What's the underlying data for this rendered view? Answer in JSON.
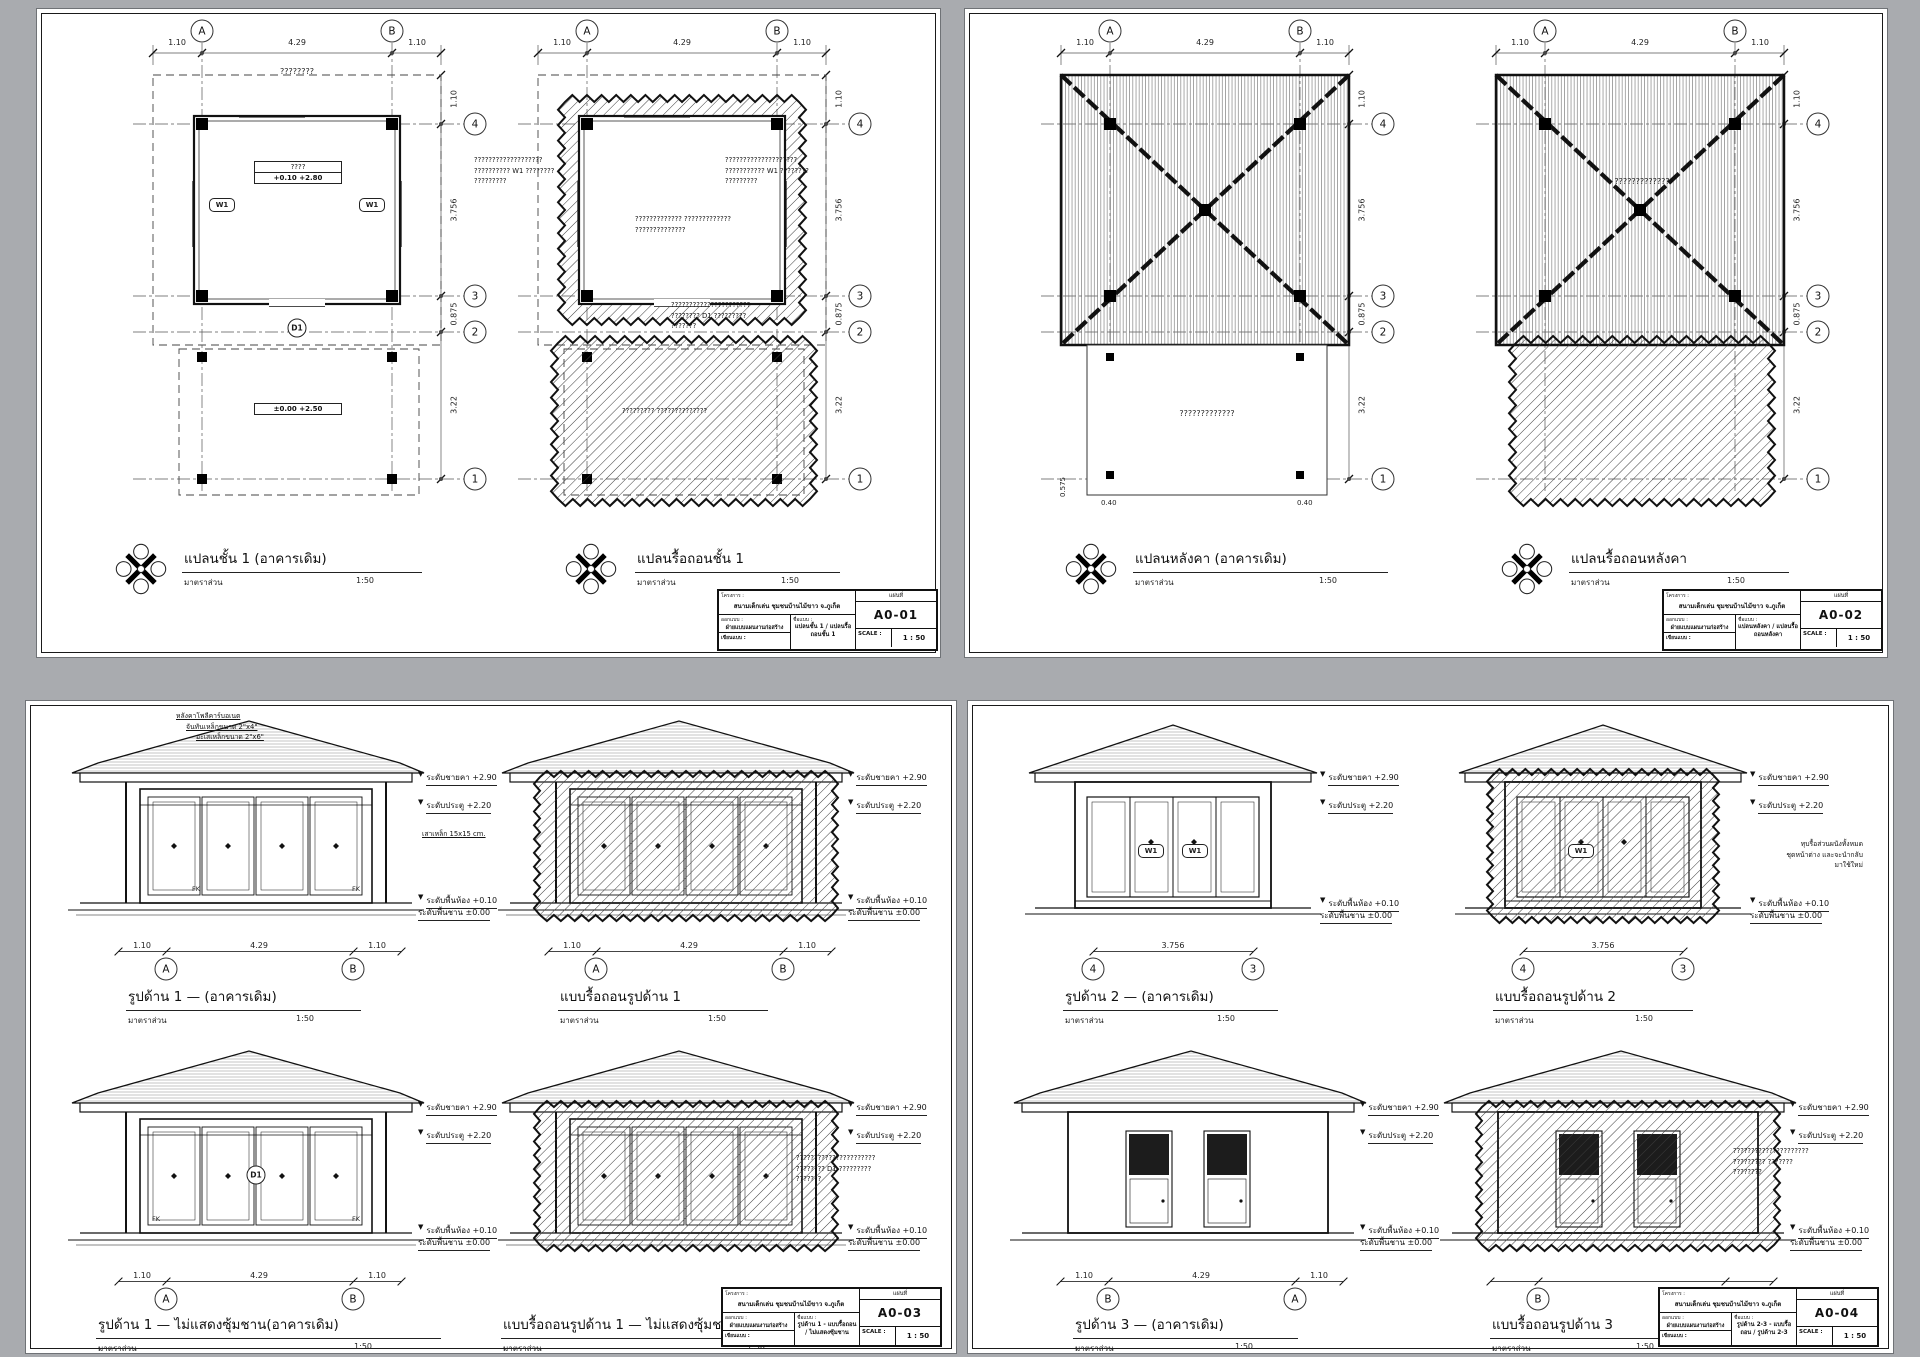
{
  "ui": {
    "bg": "#a9abaf",
    "paper": "#ffffff",
    "ink": "#1a1a1a"
  },
  "common": {
    "scale_label": "มาตราส่วน",
    "scale_value": "1:50",
    "w1": "W1",
    "d1": "D1",
    "fk": "FK"
  },
  "grids": {
    "a": "A",
    "b": "B",
    "g1": "1",
    "g2": "2",
    "g3": "3",
    "g4": "4"
  },
  "dims": {
    "d110": "1.10",
    "d429": "4.29",
    "d3756": "3.756",
    "d0875": "0.875",
    "d322": "3.22",
    "d040": "0.40",
    "d0575": "0.575"
  },
  "levels": {
    "eave": "ระดับชายคา  +2.90",
    "door": "ระดับประตู +2.20",
    "floor": "ระดับพื้นห้อง +0.10",
    "deck": "ระดับพื้นชาน ±0.00"
  },
  "plan_titles": {
    "p1": "แปลนชั้น 1 (อาคารเดิม)",
    "p2": "แปลนรื้อถอนชั้น 1",
    "p3": "แปลนหลังคา (อาคารเดิม)",
    "p4": "แปลนรื้อถอนหลังคา"
  },
  "elev_titles": {
    "e1": "รูปด้าน 1  —  (อาคารเดิม)",
    "e1d": "แบบรื้อถอนรูปด้าน 1",
    "e1n": "รูปด้าน 1  —  ไม่แสดงซุ้มชาน(อาคารเดิม)",
    "e1nd": "แบบรื้อถอนรูปด้าน 1  —  ไม่แสดงซุ้มชาน",
    "e2": "รูปด้าน 2  —  (อาคารเดิม)",
    "e2d": "แบบรื้อถอนรูปด้าน 2",
    "e3": "รูปด้าน 3  —  (อาคารเดิม)",
    "e3d": "แบบรื้อถอนรูปด้าน 3"
  },
  "ann": {
    "roof1": "หลังคาโพลีคาร์บอเนต",
    "roof2": "จันทันเหล็กขนาด 2\"x4\"",
    "roof3": "อะเสเหล็กขนาด 2\"x6\"",
    "col": "เสาเหล็ก 15x15 cm."
  },
  "tags": {
    "room_top": "????",
    "room_bot": "+0.10   +2.80",
    "deck": "±0.00   +2.50",
    "roof_q": "????????"
  },
  "qnotes": {
    "a": [
      "???????????????????",
      "?????????? W1 ????????",
      "?????????"
    ],
    "b": [
      "????????????????????",
      "??????????? W1 ????????",
      "?????????"
    ],
    "c": [
      "????????????? ?????????????",
      "??????????????"
    ],
    "d": [
      "??????????????????????",
      "???????? D1 ?????????",
      "???????"
    ],
    "e": [
      "????????? ??????????????"
    ],
    "f": [
      "?????????????"
    ],
    "g": [
      "?????????????????????",
      "????????? ???????",
      "????????"
    ]
  },
  "reuse_note": [
    "ทุบรื้อส่วนผนังทั้งหมด",
    "ชุดหน้าต่าง และจะนำกลับ",
    "มาใช้ใหม่"
  ],
  "titleblock": {
    "project_label": "โครงการ :",
    "project": "สนามเด็กเล่น ชุมชนบ้านไม้ขาว จ.ภูเก็ต",
    "owner_label": "ออกแบบ :",
    "owner": "ฝ่ายแบบแผนงานก่อสร้าง",
    "drawn_label": "เขียนแบบ :",
    "name_label": "ชื่อแบบ :",
    "sheet_label": "แผ่นที่",
    "scale_label": "SCALE :",
    "scale": "1 : 50"
  },
  "sheets": {
    "s1": {
      "code": "A0-01",
      "name": "แปลนชั้น 1 / แปลนรื้อถอนชั้น 1"
    },
    "s2": {
      "code": "A0-02",
      "name": "แปลนหลังคา / แปลนรื้อถอนหลังคา"
    },
    "s3": {
      "code": "A0-03",
      "name": "รูปด้าน 1 - แบบรื้อถอน / ไม่แสดงซุ้มชาน"
    },
    "s4": {
      "code": "A0-04",
      "name": "รูปด้าน 2-3 - แบบรื้อถอน / รูปด้าน 2-3"
    }
  }
}
